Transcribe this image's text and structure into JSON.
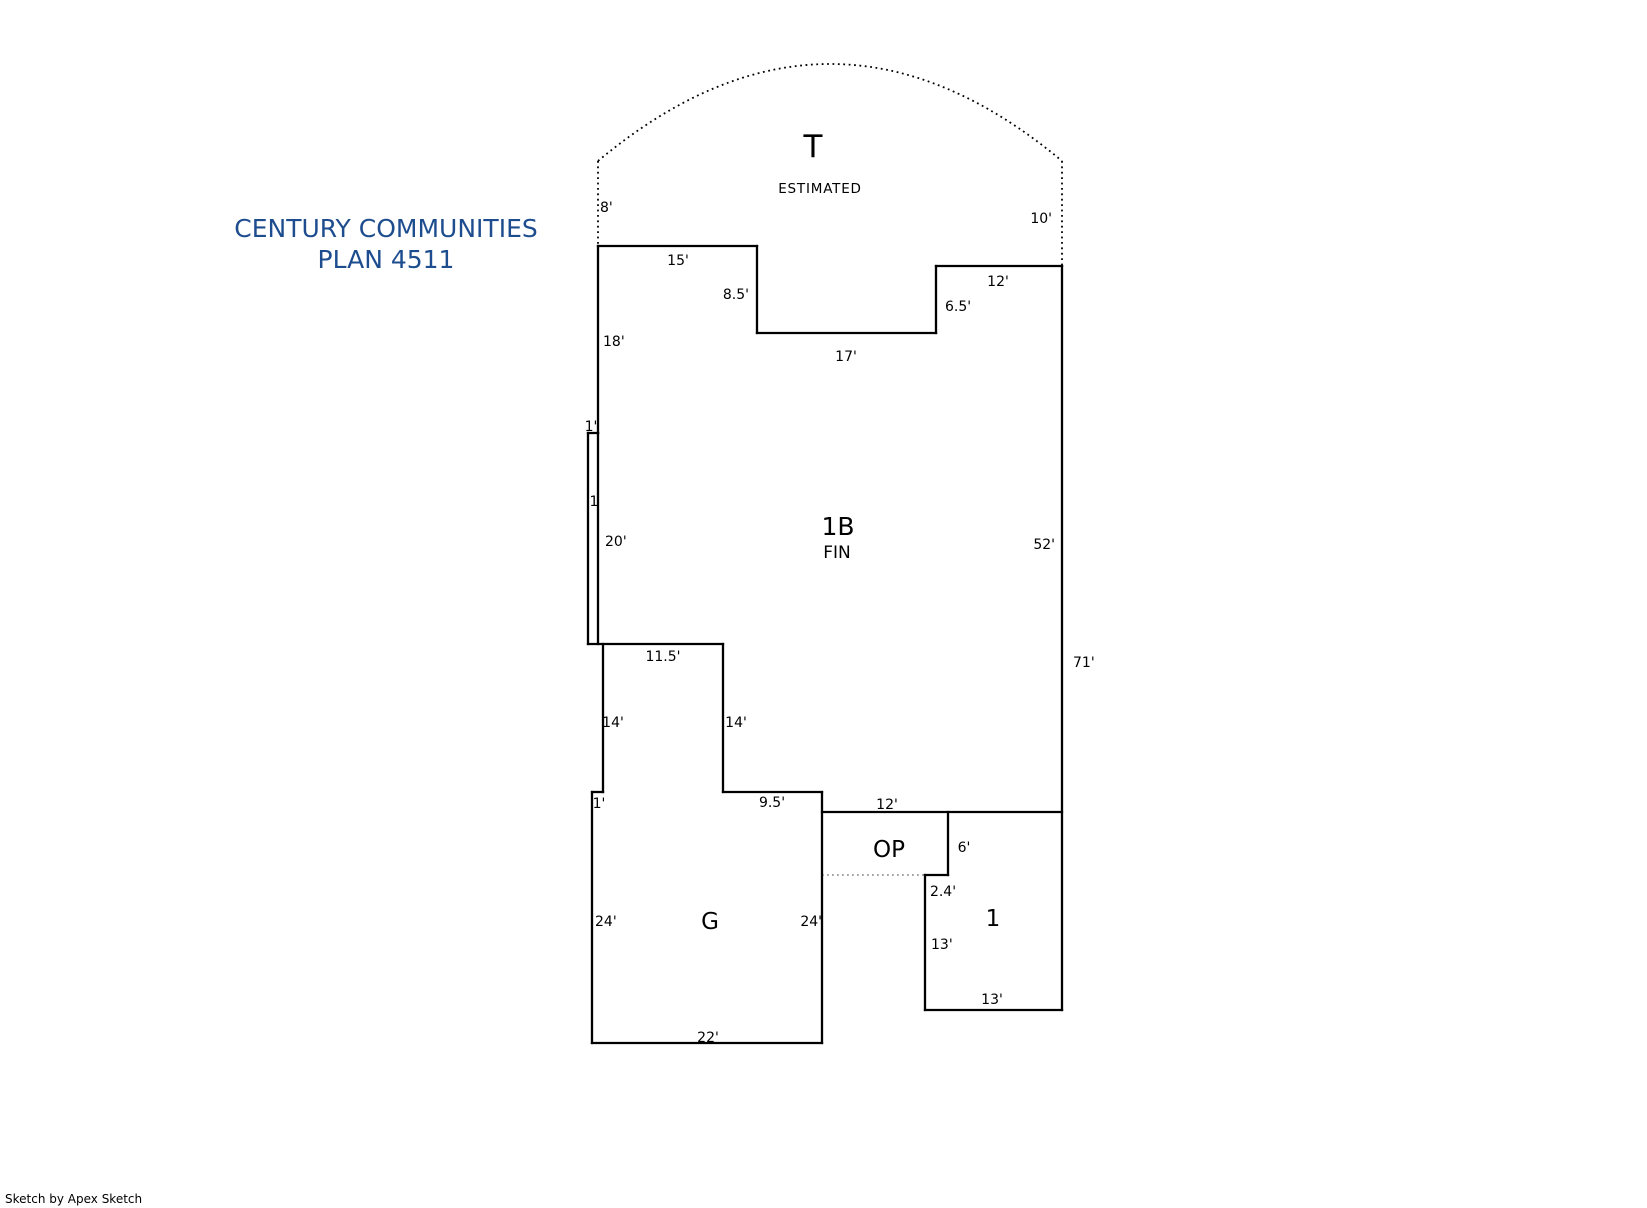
{
  "title": {
    "line1": "CENTURY COMMUNITIES",
    "line2": "PLAN 4511",
    "color": "#1d4d8e"
  },
  "footer": {
    "credit": "Sketch by Apex Sketch"
  },
  "floor_plan": {
    "line_color": "#000000",
    "dotted_gray_color": "#9a9a9a",
    "accent_blue": "#1d4d8e",
    "area_labels": [
      {
        "name": "estimated-area-t-label",
        "text": "T",
        "x": 813,
        "y": 157,
        "size": 31
      },
      {
        "name": "estimated-note-label",
        "text": "ESTIMATED",
        "x": 820,
        "y": 193,
        "size": 13.5,
        "spacing": 0.8
      },
      {
        "name": "area-1b-label",
        "text": "1B",
        "x": 838,
        "y": 535,
        "size": 25
      },
      {
        "name": "area-1b-fin-label",
        "text": "FIN",
        "x": 837,
        "y": 558,
        "size": 17
      },
      {
        "name": "area-op-label",
        "text": "OP",
        "x": 889,
        "y": 857,
        "size": 23
      },
      {
        "name": "area-1-label",
        "text": "1",
        "x": 993,
        "y": 926,
        "size": 23
      },
      {
        "name": "area-g-label",
        "text": "G",
        "x": 710,
        "y": 929,
        "size": 23
      }
    ],
    "dimension_labels": [
      {
        "text": "8'",
        "x": 600,
        "y": 212,
        "anchor": "start"
      },
      {
        "text": "10'",
        "x": 1052,
        "y": 223,
        "anchor": "end"
      },
      {
        "text": "15'",
        "x": 678,
        "y": 265,
        "anchor": "middle"
      },
      {
        "text": "8.5'",
        "x": 749,
        "y": 299,
        "anchor": "end"
      },
      {
        "text": "12'",
        "x": 998,
        "y": 286,
        "anchor": "middle"
      },
      {
        "text": "6.5'",
        "x": 945,
        "y": 311,
        "anchor": "start"
      },
      {
        "text": "17'",
        "x": 846,
        "y": 361,
        "anchor": "middle"
      },
      {
        "text": "18'",
        "x": 603,
        "y": 346,
        "anchor": "start"
      },
      {
        "text": "1'",
        "x": 591,
        "y": 431,
        "anchor": "middle"
      },
      {
        "text": "1",
        "x": 594,
        "y": 506,
        "anchor": "middle",
        "color": "#1d4d8e"
      },
      {
        "text": "20'",
        "x": 605,
        "y": 546,
        "anchor": "start"
      },
      {
        "text": "52'",
        "x": 1055,
        "y": 549,
        "anchor": "end"
      },
      {
        "text": "71'",
        "x": 1073,
        "y": 667,
        "anchor": "start"
      },
      {
        "text": "11.5'",
        "x": 663,
        "y": 661,
        "anchor": "middle"
      },
      {
        "text": "14'",
        "x": 613,
        "y": 727,
        "anchor": "middle"
      },
      {
        "text": "14'",
        "x": 736,
        "y": 727,
        "anchor": "middle"
      },
      {
        "text": "1'",
        "x": 599,
        "y": 808,
        "anchor": "middle"
      },
      {
        "text": "9.5'",
        "x": 772,
        "y": 807,
        "anchor": "middle"
      },
      {
        "text": "12'",
        "x": 887,
        "y": 809,
        "anchor": "middle"
      },
      {
        "text": "6'",
        "x": 964,
        "y": 852,
        "anchor": "middle"
      },
      {
        "text": "2.4'",
        "x": 943,
        "y": 896,
        "anchor": "middle"
      },
      {
        "text": "13'",
        "x": 931,
        "y": 949,
        "anchor": "start"
      },
      {
        "text": "13'",
        "x": 992,
        "y": 1004,
        "anchor": "middle"
      },
      {
        "text": "24'",
        "x": 595,
        "y": 926,
        "anchor": "start"
      },
      {
        "text": "24'",
        "x": 822,
        "y": 926,
        "anchor": "end"
      },
      {
        "text": "22'",
        "x": 708,
        "y": 1042,
        "anchor": "middle"
      }
    ],
    "walls": [
      [
        598,
        246,
        757,
        246
      ],
      [
        757,
        246,
        757,
        333
      ],
      [
        757,
        333,
        936,
        333
      ],
      [
        936,
        333,
        936,
        266
      ],
      [
        936,
        266,
        1062,
        266
      ],
      [
        1062,
        266,
        1062,
        1010
      ],
      [
        598,
        246,
        598,
        433
      ],
      [
        598,
        433,
        588,
        433
      ],
      [
        588,
        433,
        588,
        644
      ],
      [
        598,
        433,
        598,
        644
      ],
      [
        588,
        644,
        723,
        644
      ],
      [
        603,
        644,
        603,
        792
      ],
      [
        723,
        644,
        723,
        792
      ],
      [
        723,
        792,
        822,
        792
      ],
      [
        603,
        792,
        592,
        792
      ],
      [
        592,
        792,
        592,
        1043
      ],
      [
        592,
        1043,
        822,
        1043
      ],
      [
        822,
        792,
        822,
        1043
      ],
      [
        822,
        812,
        1062,
        812
      ],
      [
        948,
        812,
        948,
        875
      ],
      [
        925,
        875,
        948,
        875
      ],
      [
        925,
        875,
        925,
        1010
      ],
      [
        925,
        1010,
        1062,
        1010
      ]
    ],
    "dotted_black": [
      [
        598,
        161,
        598,
        246
      ],
      [
        1062,
        161,
        1062,
        266
      ]
    ],
    "estimated_arc_path": "M 598 161 Q 830 -33 1062 161",
    "dotted_gray": [
      [
        822,
        875,
        925,
        875
      ]
    ]
  }
}
